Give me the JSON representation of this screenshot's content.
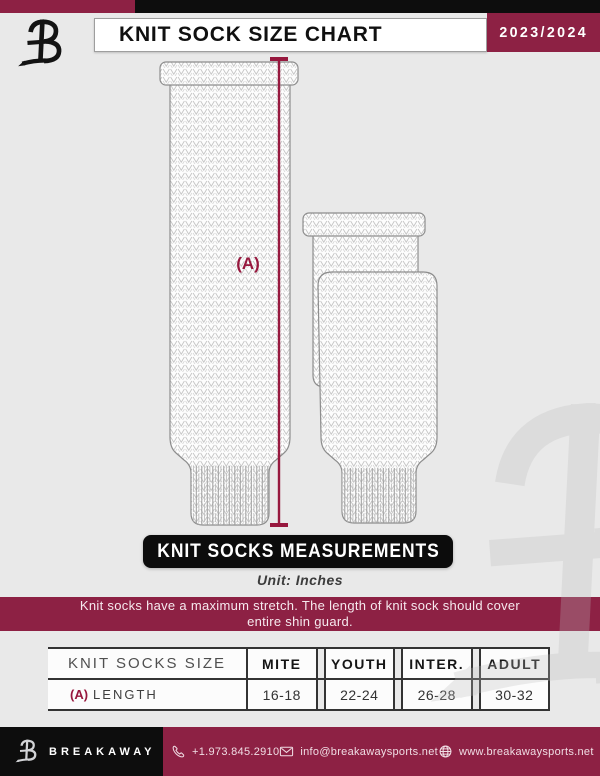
{
  "header": {
    "title": "KNIT SOCK SIZE CHART",
    "season": "2023/2024"
  },
  "diagram": {
    "dimension_label": "(A)",
    "banner": "KNIT SOCKS MEASUREMENTS",
    "unit_note": "Unit: Inches",
    "notice_line1": "Knit socks have a maximum stretch. The length of knit sock should cover",
    "notice_line2": "entire shin guard."
  },
  "table": {
    "columns": [
      "KNIT SOCKS SIZE",
      "MITE",
      "YOUTH",
      "INTER.",
      "ADULT"
    ],
    "row": {
      "key": "(A)",
      "label": "LENGTH",
      "values": [
        "16-18",
        "22-24",
        "26-28",
        "30-32"
      ]
    }
  },
  "footer": {
    "brand": "BREAKAWAY",
    "phone": "+1.973.845.2910",
    "email": "info@breakawaysports.net",
    "website": "www.breakawaysports.net"
  },
  "colors": {
    "maroon": "#8d2144",
    "measure_line": "#97183e",
    "black": "#0d0d0d",
    "background": "#e9e9e9"
  }
}
